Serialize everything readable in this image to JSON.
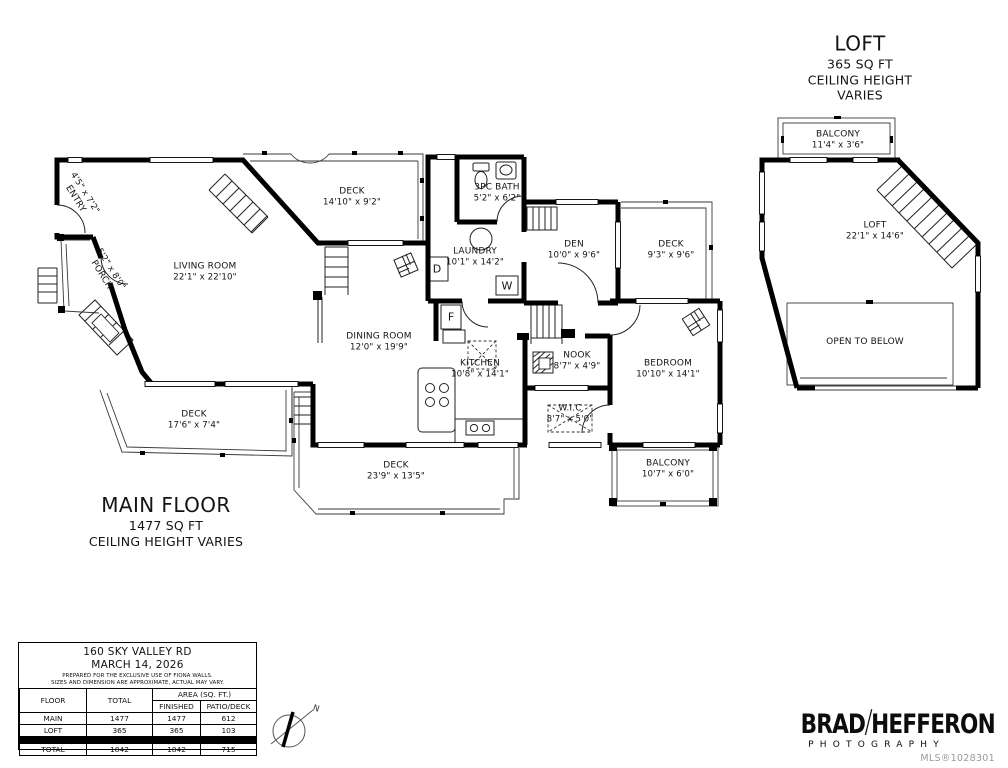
{
  "main_plan": {
    "title": "MAIN FLOOR",
    "area": "1477 SQ FT",
    "note": "CEILING HEIGHT VARIES"
  },
  "loft_plan": {
    "title": "LOFT",
    "area": "365 SQ FT",
    "note": "CEILING HEIGHT VARIES"
  },
  "rooms": {
    "entry": {
      "name": "ENTRY",
      "dims": "4'5\" x 7'2\""
    },
    "porch": {
      "name": "PORCH",
      "dims": "5'2\" x 8'0\""
    },
    "living": {
      "name": "LIVING ROOM",
      "dims": "22'1\" x 22'10\""
    },
    "deck_top": {
      "name": "DECK",
      "dims": "14'10\" x 9'2\""
    },
    "bath": {
      "name": "3PC BATH",
      "dims": "5'2\" x 6'2\""
    },
    "laundry": {
      "name": "LAUNDRY",
      "dims": "10'1\" x 14'2\""
    },
    "den": {
      "name": "DEN",
      "dims": "10'0\" x 9'6\""
    },
    "deck_right": {
      "name": "DECK",
      "dims": "9'3\" x 9'6\""
    },
    "dining": {
      "name": "DINING ROOM",
      "dims": "12'0\" x 19'9\""
    },
    "kitchen": {
      "name": "KITCHEN",
      "dims": "10'8\" x 14'1\""
    },
    "nook": {
      "name": "NOOK",
      "dims": "8'7\" x 4'9\""
    },
    "bedroom": {
      "name": "BEDROOM",
      "dims": "10'10\" x 14'1\""
    },
    "wic": {
      "name": "W.I.C",
      "dims": "8'7\" x 5'0\""
    },
    "deck_bottom": {
      "name": "DECK",
      "dims": "23'9\" x 13'5\""
    },
    "balcony_main": {
      "name": "BALCONY",
      "dims": "10'7\" x 6'0\""
    },
    "deck_left": {
      "name": "DECK",
      "dims": "17'6\" x 7'4\""
    },
    "loft_balcony": {
      "name": "BALCONY",
      "dims": "11'4\" x 3'6\""
    },
    "loft_room": {
      "name": "LOFT",
      "dims": "22'1\" x 14'6\""
    },
    "open_below": {
      "name": "OPEN TO BELOW"
    }
  },
  "appliances": {
    "dryer": "D",
    "washer": "W",
    "furnace": "F"
  },
  "compass": {
    "north": "N"
  },
  "info_table": {
    "address": "160 SKY VALLEY RD",
    "date": "MARCH 14, 2026",
    "disclaimer1": "PREPARED FOR THE EXCLUSIVE USE OF FIONA WALLS.",
    "disclaimer2": "SIZES AND DIMENSION ARE APPROXIMATE, ACTUAL MAY VARY.",
    "headers": {
      "floor": "FLOOR",
      "total": "TOTAL",
      "area": "AREA (SQ. FT.)",
      "finished": "FINISHED",
      "patio": "PATIO/DECK"
    },
    "rows": [
      {
        "floor": "MAIN",
        "total": "1477",
        "finished": "1477",
        "patio": "612"
      },
      {
        "floor": "LOFT",
        "total": "365",
        "finished": "365",
        "patio": "103"
      }
    ],
    "total_row": {
      "floor": "TOTAL",
      "total": "1842",
      "finished": "1842",
      "patio": "715"
    }
  },
  "branding": {
    "first": "BRAD",
    "slash": "/",
    "second": "HEFFERON",
    "tagline": "PHOTOGRAPHY",
    "mls": "MLS®1028301"
  }
}
